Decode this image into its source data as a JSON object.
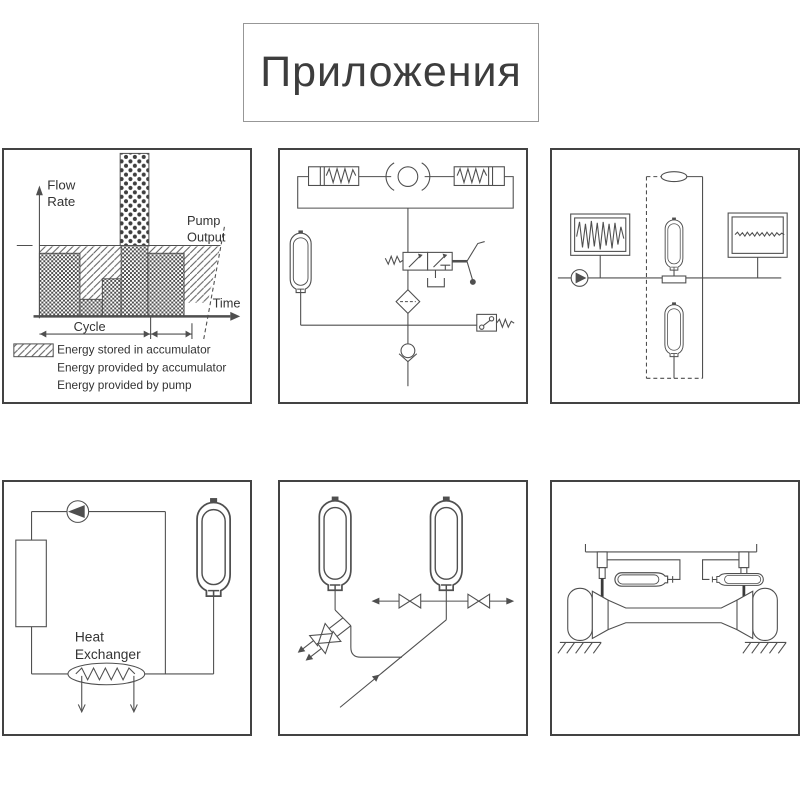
{
  "page": {
    "title": "Приложения",
    "background": "#ffffff",
    "line_color": "#4f4f4f",
    "text_color": "#333333",
    "panel_border_color": "#434343"
  },
  "panels": {
    "energy_chart": {
      "y_axis_label": [
        "Flow",
        "Rate"
      ],
      "pump_output_label": [
        "Pump",
        "Output"
      ],
      "time_label": "Time",
      "cycle_label": "Cycle",
      "legend": [
        "Energy stored in accumulator",
        "Energy provided by accumulator",
        "Energy provided by pump"
      ]
    },
    "brake_circuit": {
      "symbols": [
        "spring-return-cylinder-left",
        "wheel-drum",
        "spring-return-cylinder-right",
        "bladder-accumulator",
        "lever-directional-valve",
        "tank",
        "filter",
        "pressure-switch",
        "check-valve"
      ]
    },
    "pulsation_damping": {
      "symbols": [
        "pump",
        "oscilloscope-noisy-wave",
        "inline-damper",
        "bladder-accumulator-on-line",
        "bladder-accumulator-branch",
        "oscilloscope-smooth-wave",
        "dashed-enclosure"
      ]
    },
    "thermal_circuit": {
      "heat_exchanger_label": [
        "Heat",
        "Exchanger"
      ],
      "symbols": [
        "circulation-pump",
        "heater-column",
        "bladder-accumulator",
        "heat-exchanger-coil",
        "flow-arrows"
      ]
    },
    "accumulator_bank": {
      "symbols": [
        "bladder-accumulator-left",
        "bladder-accumulator-right",
        "shutoff-valve",
        "flow-arrows",
        "supply-line"
      ]
    },
    "suspension": {
      "symbols": [
        "vehicle-frame",
        "suspension-strut-left",
        "suspension-strut-right",
        "horizontal-accumulator-left",
        "horizontal-accumulator-right",
        "axle-beam",
        "wheel-left",
        "wheel-right",
        "ground-hatch"
      ]
    }
  },
  "chart_data": {
    "type": "area",
    "title": "",
    "xlabel": "Time",
    "ylabel": "Flow Rate",
    "y_units": "relative (pump output = 1.0)",
    "pump_output_level": 1.0,
    "demand_profile": [
      {
        "t_start": 0.0,
        "t_end": 0.28,
        "flow": 0.89
      },
      {
        "t_start": 0.28,
        "t_end": 0.435,
        "flow": 0.24
      },
      {
        "t_start": 0.435,
        "t_end": 0.565,
        "flow": 0.53
      },
      {
        "t_start": 0.565,
        "t_end": 0.75,
        "flow": 2.3
      },
      {
        "t_start": 0.75,
        "t_end": 1.0,
        "flow": 0.89
      }
    ],
    "cycle_marks_t": [
      0.0,
      0.77,
      1.05
    ],
    "annotations": [
      "Pump Output",
      "Cycle"
    ],
    "legend": [
      "Energy stored in accumulator",
      "Energy provided by accumulator",
      "Energy provided by pump"
    ],
    "grid": false,
    "legend_position": "below"
  }
}
